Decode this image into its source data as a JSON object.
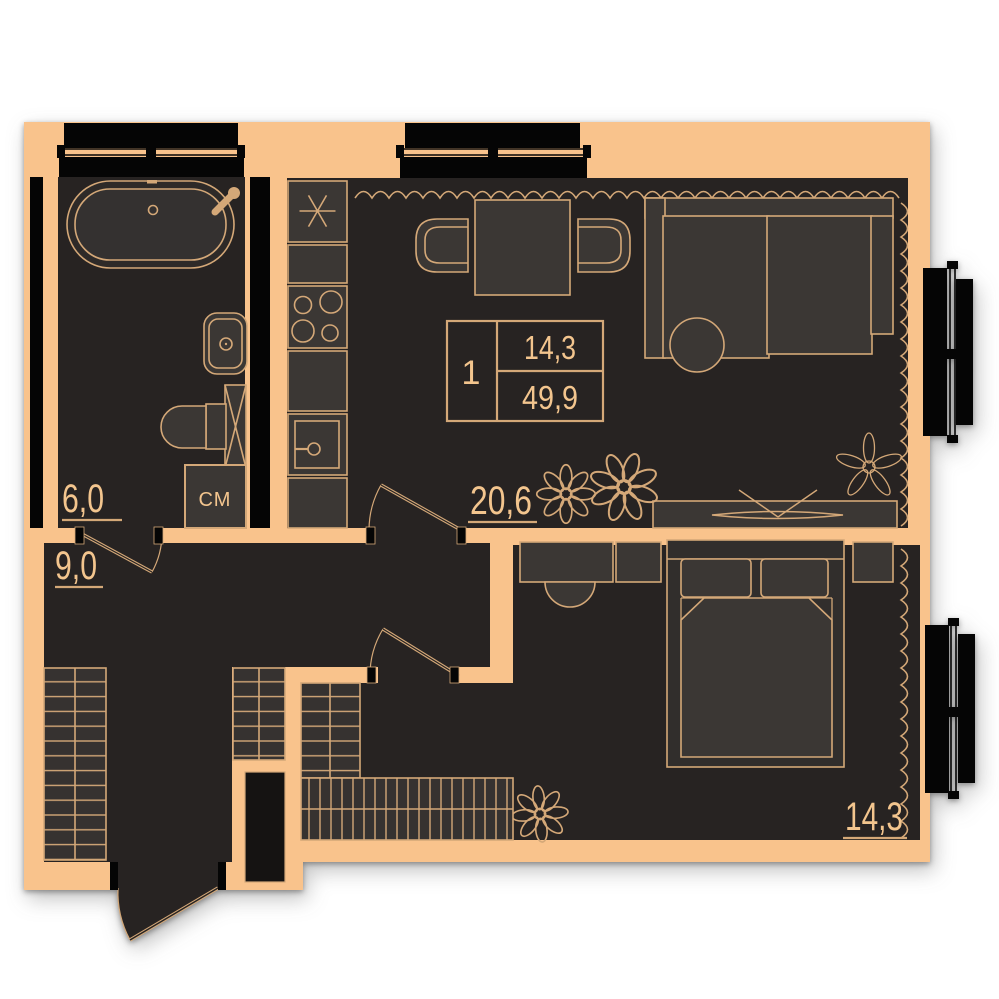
{
  "plan": {
    "title": "apartment-floor-plan",
    "info_box": {
      "rooms_count": "1",
      "living_area": "14,3",
      "total_area": "49,9"
    },
    "rooms": {
      "bathroom": {
        "area": "6,0"
      },
      "hallway": {
        "area": "9,0"
      },
      "living_kitchen": {
        "area": "20,6"
      },
      "bedroom": {
        "area": "14,3"
      }
    },
    "appliances": {
      "washing_machine": "СМ"
    }
  },
  "colors": {
    "wall": "#F9C38C",
    "floor": "#272322",
    "furniture_fill": "#3B3734",
    "outline": "#D4A878",
    "text": "#F3C58E",
    "window_black": "#050505",
    "background": "#FFFFFF"
  }
}
